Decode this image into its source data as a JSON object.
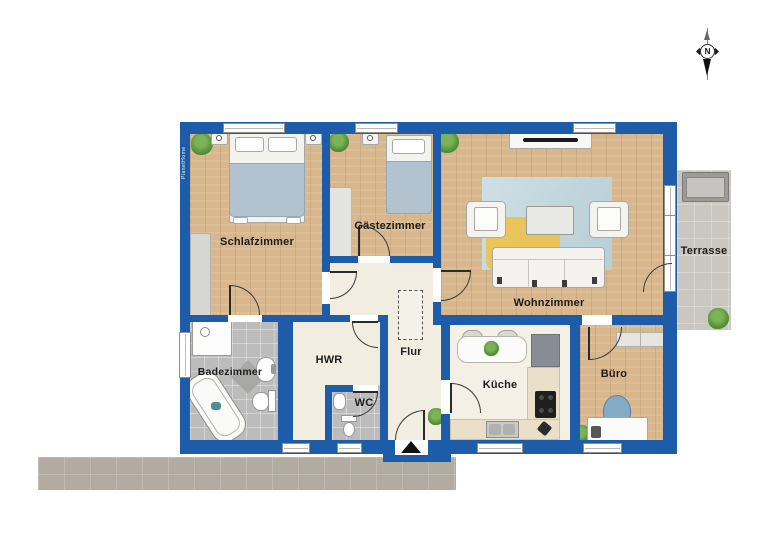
{
  "floor_plan": {
    "watermark": "PlanetHome",
    "compass": {
      "north_label": "N"
    },
    "rooms": [
      {
        "id": "schlafzimmer",
        "label": "Schlafzimmer"
      },
      {
        "id": "gaestezimmer",
        "label": "Gästezimmer"
      },
      {
        "id": "wohnzimmer",
        "label": "Wohnzimmer"
      },
      {
        "id": "badezimmer",
        "label": "Badezimmer"
      },
      {
        "id": "hwr",
        "label": "HWR"
      },
      {
        "id": "flur",
        "label": "Flur"
      },
      {
        "id": "wc",
        "label": "WC"
      },
      {
        "id": "kueche",
        "label": "Küche"
      },
      {
        "id": "buero",
        "label": "Büro"
      },
      {
        "id": "terrasse",
        "label": "Terrasse"
      }
    ],
    "colors": {
      "wall_blue": "#1d5ca8",
      "wood_floor": "#d8b78d",
      "hall_floor": "#f1ede1",
      "tile_floor": "#bcbcbc",
      "terrace": "#cac7c1",
      "walkway": "#b1aba0",
      "rug_blue": "#c6d9de",
      "rug_yellow": "#ecc14b",
      "bed_blanket": "#b2c2ce",
      "office_chair": "#85aac6"
    }
  }
}
